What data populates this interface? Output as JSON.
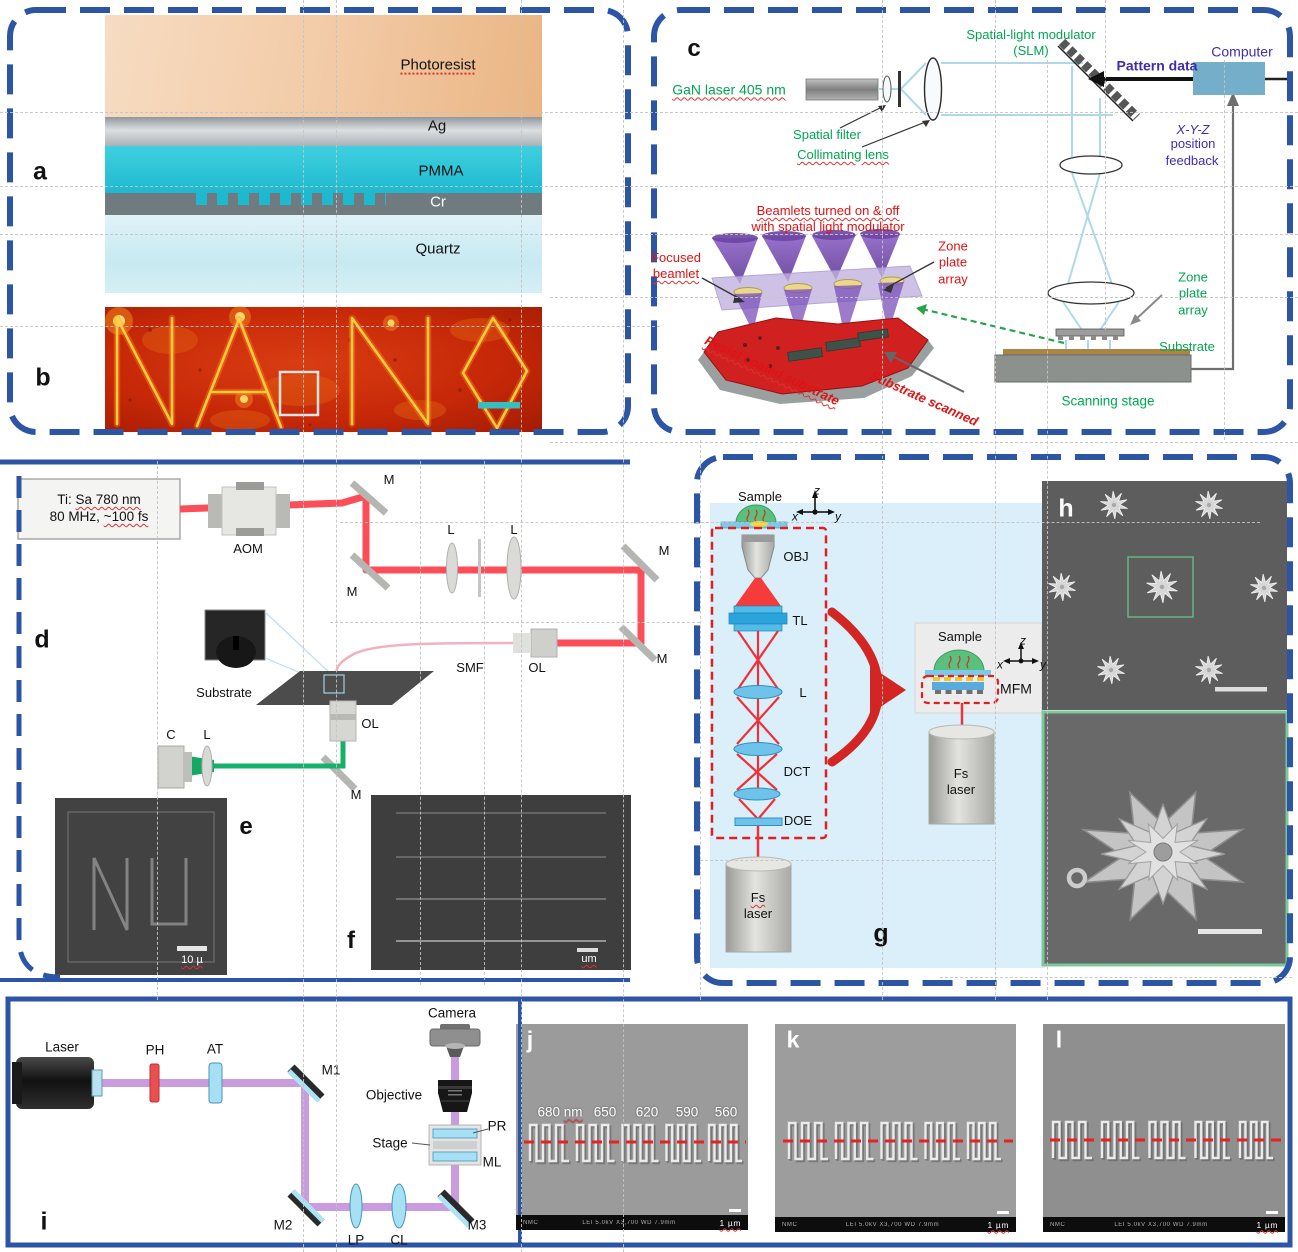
{
  "colors": {
    "accent_blue": "#2d55a5",
    "green": "#00a651",
    "red": "#e01212",
    "purple": "#3f2db0",
    "panel_g_bg": "#daeffa"
  },
  "panel_a": {
    "label": "a",
    "photoresist": "Photoresist",
    "ag": "Ag",
    "pmma": "PMMA",
    "cr": "Cr",
    "quartz": "Quartz"
  },
  "panel_b": {
    "label": "b",
    "afm_text": "NANO"
  },
  "panel_c": {
    "label": "c",
    "gan_laser": "GaN laser 405 nm",
    "slm_line1": "Spatial-light modulator",
    "slm_line2": "(SLM)",
    "pattern_data": "Pattern data",
    "computer": "Computer",
    "xyz": "X-Y-Z",
    "position": "position",
    "feedback": "feedback",
    "spatial_filter": "Spatial filter",
    "collimating_lens": "Collimating lens",
    "beamlets_line1": "Beamlets turned on & off",
    "beamlets_line2": "with spatial light modulator",
    "focused_line1": "Focused",
    "focused_line2": "beamlet",
    "zone_1": "Zone",
    "zone_2": "plate",
    "zone_3": "array",
    "resist": "Resist coated substrate",
    "scanned": "Substrate scanned",
    "substrate": "Substrate",
    "scanning_stage": "Scanning stage"
  },
  "panel_d": {
    "label": "d",
    "laser_ti": "Ti:",
    "laser_sa": "Sa 780 nm",
    "laser_mhz": "80 MHz,",
    "laser_fs": "~100 fs",
    "aom": "AOM",
    "m": "M",
    "l": "L",
    "smf": "SMF",
    "ol": "OL",
    "substrate": "Substrate",
    "c": "C"
  },
  "panel_e": {
    "label": "e",
    "scale": "10 µ"
  },
  "panel_f": {
    "label": "f",
    "scale": "um"
  },
  "panel_g": {
    "label": "g",
    "sample": "Sample",
    "obj": "OBJ",
    "tl": "TL",
    "l": "L",
    "dct": "DCT",
    "doe": "DOE",
    "fs": "Fs",
    "laser": "laser",
    "mfm": "MFM",
    "ax_x": "x",
    "ax_y": "y",
    "ax_z": "z"
  },
  "panel_h": {
    "label": "h"
  },
  "panel_i": {
    "label": "i",
    "laser": "Laser",
    "ph": "PH",
    "at": "AT",
    "m1": "M1",
    "m2": "M2",
    "m3": "M3",
    "lp": "LP",
    "cl": "CL",
    "ml": "ML",
    "pr": "PR",
    "stage": "Stage",
    "objective": "Objective",
    "camera": "Camera"
  },
  "panel_j": {
    "label": "j",
    "s680": "680",
    "nm": "nm",
    "s650": "650",
    "s620": "620",
    "s590": "590",
    "s560": "560",
    "scale": "1 µm",
    "meta_left": "NMC",
    "meta": "LEI    5.0kV    X3,700    WD 7.9mm"
  },
  "panel_k": {
    "label": "k",
    "scale": "1 µm",
    "meta_left": "NMC",
    "meta": "LEI    5.0kV    X3,700    WD 7.9mm"
  },
  "panel_l": {
    "label": "l",
    "scale": "1 µm",
    "meta_left": "NMC",
    "meta": "LEI    5.0kV    X3,700    WD 7.9mm"
  }
}
